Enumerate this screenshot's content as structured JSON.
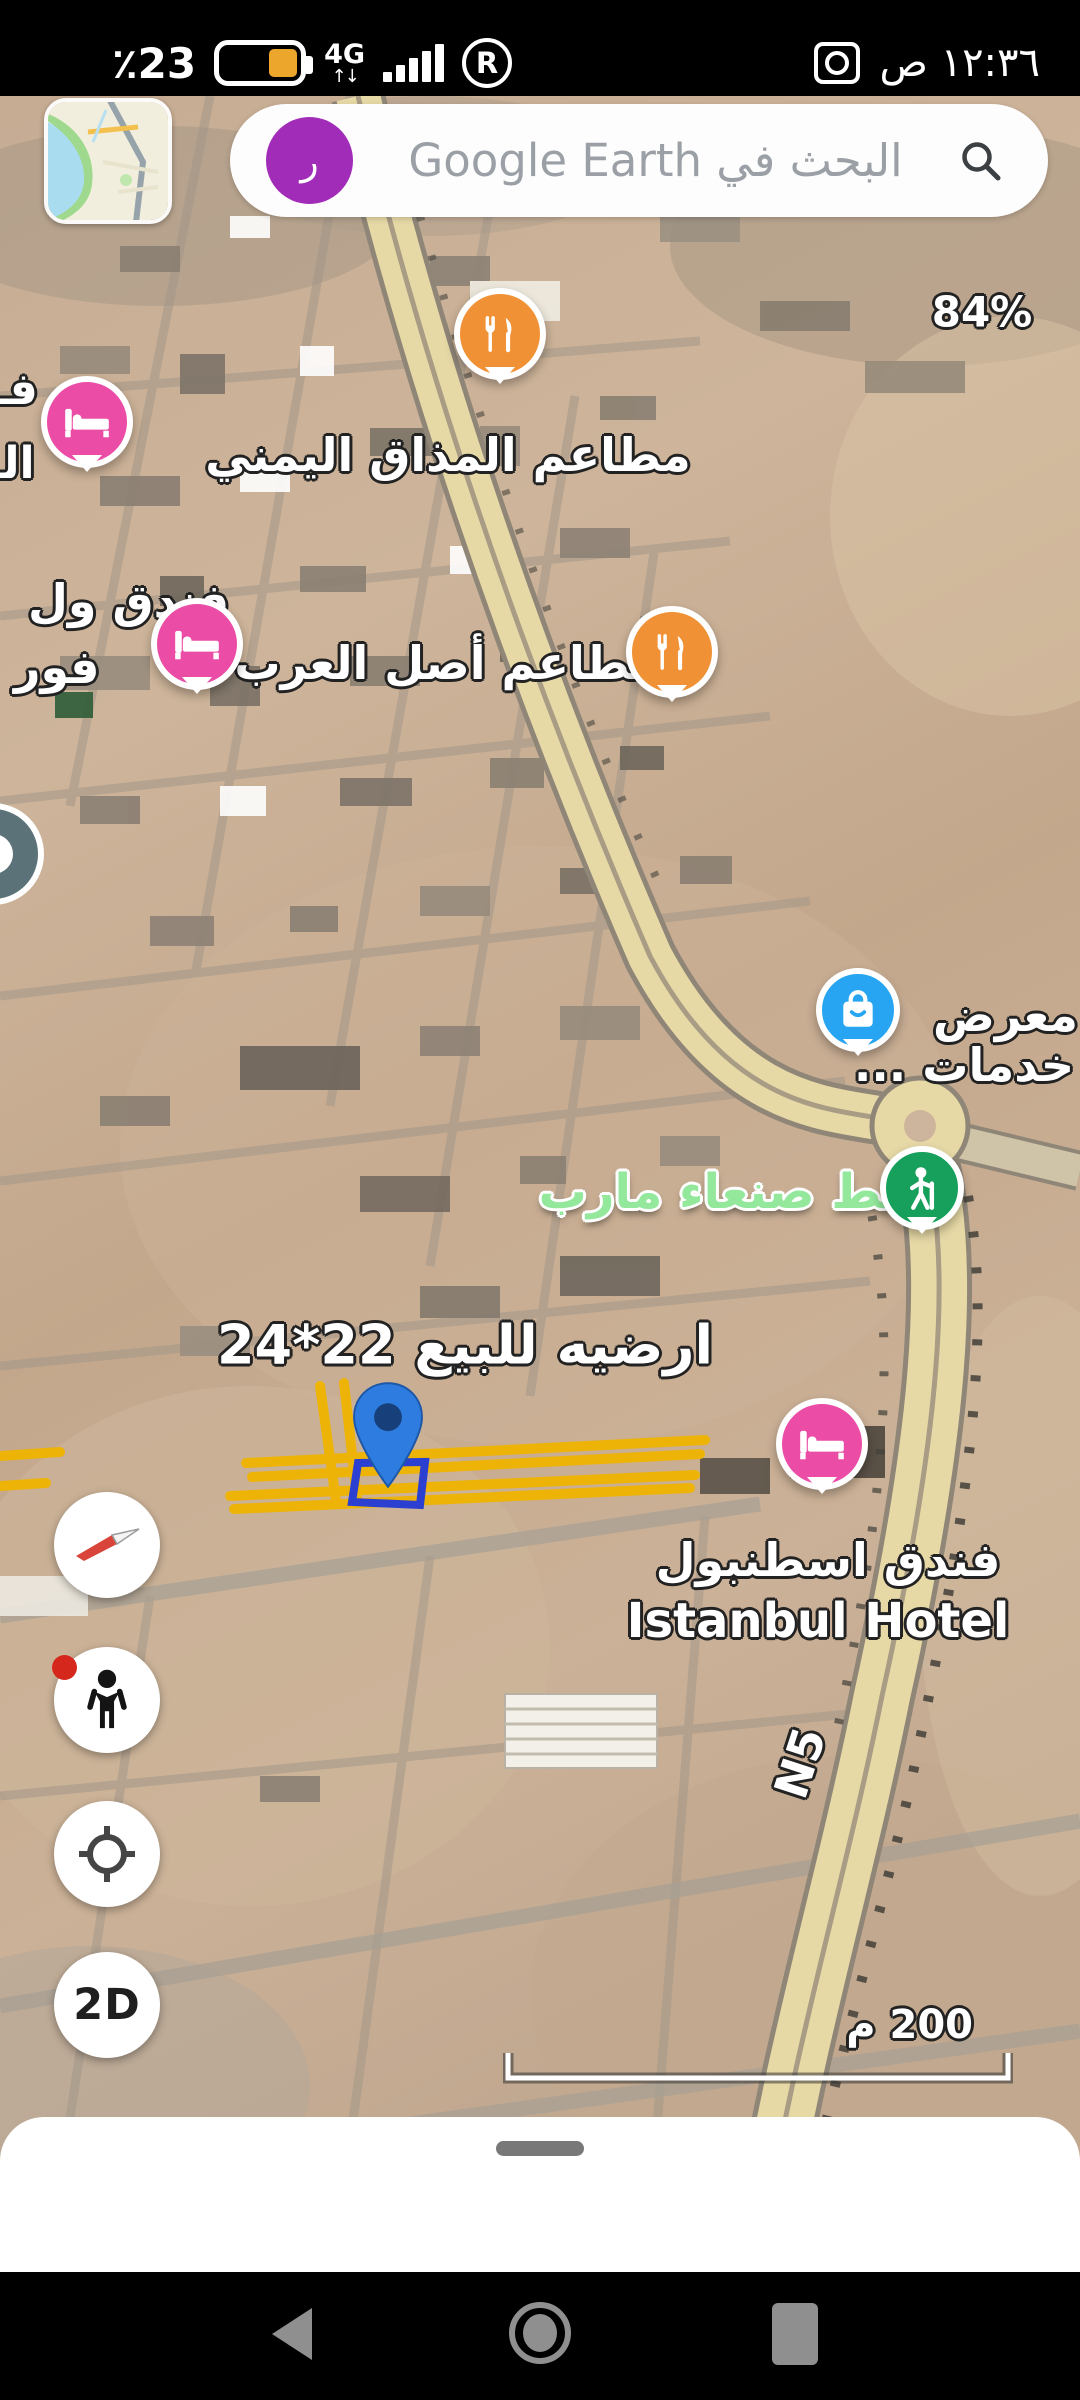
{
  "status_bar": {
    "battery_percent": "٪23",
    "network_type": "4G",
    "network_arrows": "↑↓",
    "roaming_indicator": "R",
    "time": "١٢:٣٦ ص"
  },
  "search_bar": {
    "avatar_letter": "ر",
    "placeholder": "البحث في Google Earth"
  },
  "map": {
    "streaming_percent": "84%",
    "scale_label": "200 م",
    "road_route_label": "N5",
    "labels": {
      "restaurant_yemeni": "مطاعم المذاق اليمني",
      "restaurant_arab": "مطاعم أصل العرب",
      "hotel_left_partial_top": "فـ",
      "hotel_left_partial_mid": "الـ",
      "hotel_left_line1": "فندق ول",
      "hotel_left_line2": "فور",
      "showroom_line1": "معرض",
      "showroom_line2": "خدمات ...",
      "sanaa_marib_line": "خط صنعاء مارب",
      "land_for_sale": "ارضيه للبيع 22*24",
      "istanbul_hotel_ar": "فندق اسطنبول",
      "istanbul_hotel_en": "Istanbul Hotel"
    }
  },
  "controls": {
    "view_mode": "2D"
  },
  "colors": {
    "pin_orange": "#f09136",
    "pin_pink": "#ea4ca6",
    "pin_blue": "#28a5f2",
    "pin_green": "#17a05c",
    "marker_blue": "#2e7ce0",
    "green_label": "#93e89c",
    "highlight_yellow": "#f0b400",
    "plot_outline_blue": "#2b3fd0",
    "avatar_purple": "#a12cb8",
    "battery_fill": "#eda62c"
  }
}
